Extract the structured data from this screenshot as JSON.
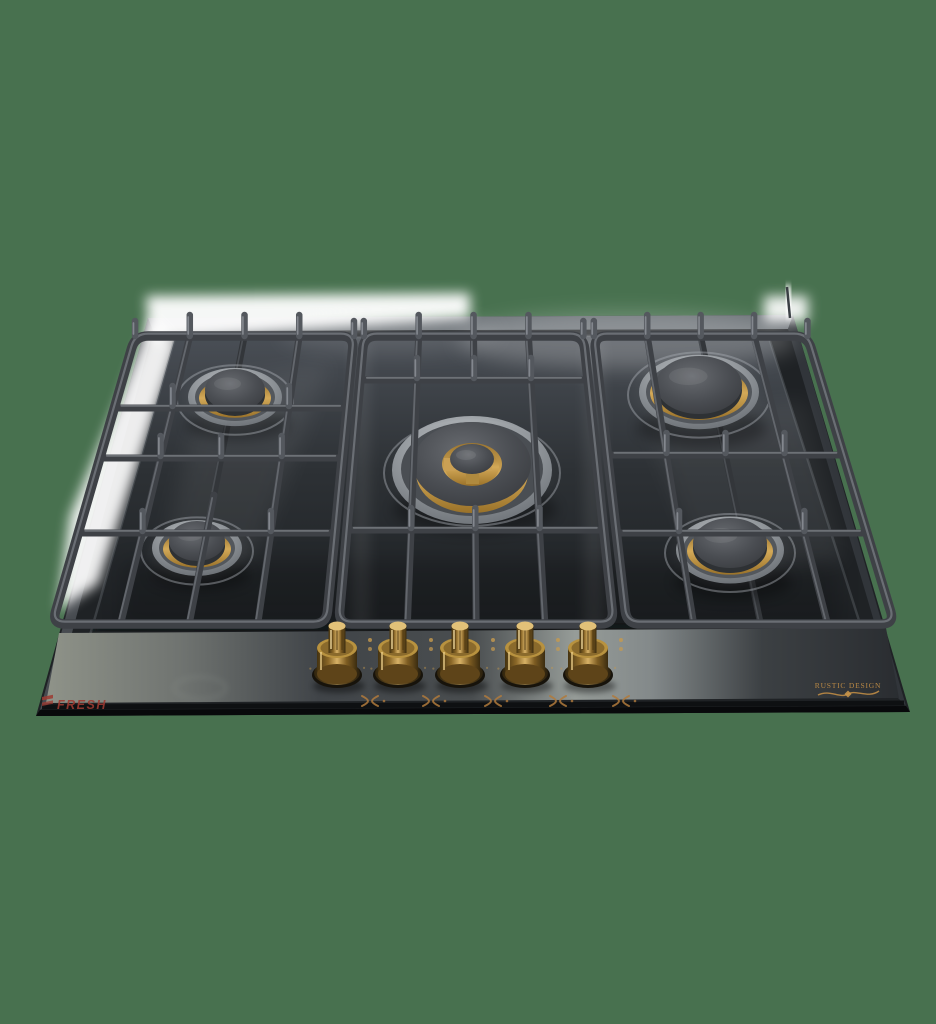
{
  "background": {
    "color": "#48714F"
  },
  "product": {
    "name": "Built-in 5-burner gas hob, black glass, cast-iron grates, brass knobs",
    "brand": "FRESH",
    "series": "RUSTIC DESIGN",
    "burner_count": 5,
    "knob_count": 5,
    "burners": [
      {
        "position": "back-left",
        "size": "auxiliary"
      },
      {
        "position": "front-left",
        "size": "semi-rapid"
      },
      {
        "position": "center",
        "size": "wok-double-ring"
      },
      {
        "position": "back-right",
        "size": "rapid"
      },
      {
        "position": "front-right",
        "size": "semi-rapid"
      }
    ],
    "icons": {
      "knob_icon": "pan-support-cross-icon",
      "marker_icon": "flame-level-dots"
    },
    "colors": {
      "background_green": "#48714F",
      "glass": "#1f2225",
      "tray_top": "#454a51",
      "tray_bottom": "#1c1f22",
      "grate": "#3e4146",
      "grate_highlight": "#7d8187",
      "finger": "#54585e",
      "brass": "#c9a052",
      "brass_dark": "#7d5c22",
      "gold": "#c69a4e",
      "brand_red": "#9e3a31",
      "chrome": "#9fa4a9",
      "halo_white": "#ffffff"
    }
  }
}
